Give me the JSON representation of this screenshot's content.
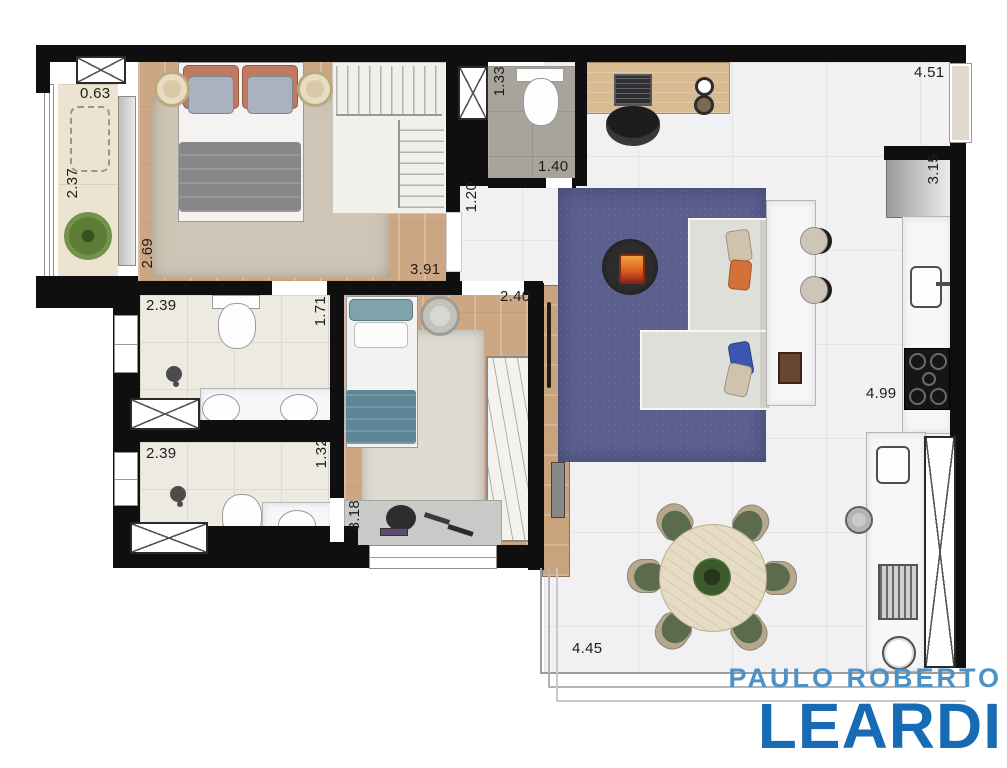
{
  "plan": {
    "title": "apartment-floor-plan",
    "dimensions": {
      "balcony_width": "0.63",
      "balcony_depth": "2.37",
      "bedroom1_depth": "2.69",
      "bedroom1_width": "3.91",
      "wc_width": "1.33",
      "wc_depth": "1.40",
      "hall_width": "1.20",
      "living_top_width": "4.51",
      "kitchen_niche_depth": "3.15",
      "bath1_width": "2.39",
      "bath1_depth": "1.71",
      "bath2_width": "2.39",
      "bath2_depth": "1.32",
      "bedroom2_width": "2.40",
      "bedroom2_depth": "3.18",
      "kitchen_run_length": "4.99",
      "living_bottom_width": "4.45"
    },
    "brand": {
      "line1": "PAULO ROBERTO",
      "line2": "LEARDI",
      "line1_color": "#4d92c6",
      "line2_color": "#176bb5"
    },
    "colors": {
      "wall": "#0f0f0f",
      "wood_floor": "#cda783",
      "marble_floor": "#f1f1f4",
      "bath_floor": "#edeae1",
      "powder_floor": "#a8a39b",
      "balcony_floor": "#ece4d0",
      "area_rug_blue": "#5a5f8e",
      "area_rug_beige": "#cfc6b8",
      "sofa": "#dfdfd9",
      "dining_chair_green": "#5c6b4d",
      "fireplace_orange": "#d96a2a"
    }
  }
}
